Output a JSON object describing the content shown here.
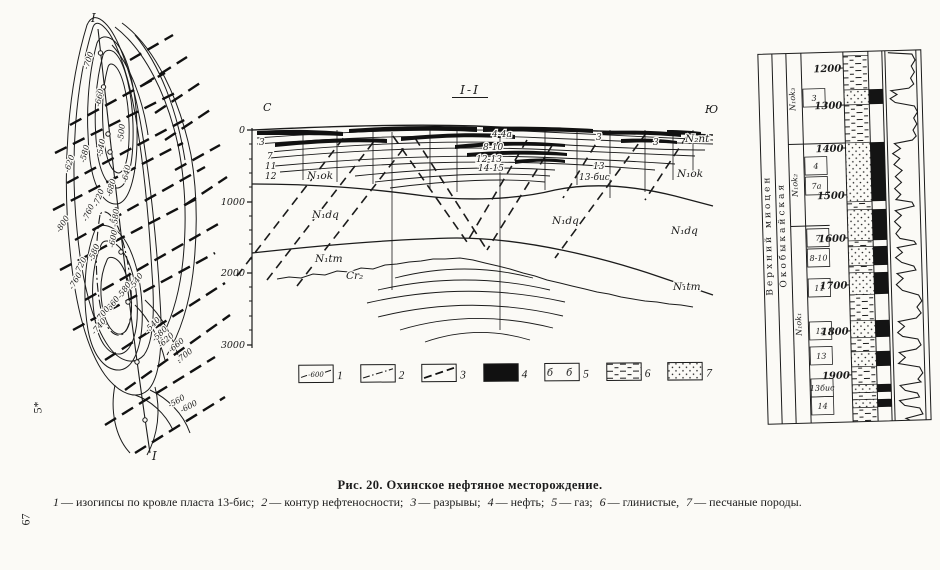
{
  "page": {
    "caption_title": "Рис. 20. Охинское нефтяное месторождение.",
    "caption_parts": [
      {
        "n": "1",
        "t": "— изогипсы по кровле пласта 13-бис;"
      },
      {
        "n": "2",
        "t": "— контур нефтеносности;"
      },
      {
        "n": "3",
        "t": "— разрывы;"
      },
      {
        "n": "4",
        "t": "— нефть;"
      },
      {
        "n": "5",
        "t": "— газ;"
      },
      {
        "n": "6",
        "t": "— глинистые,"
      },
      {
        "n": "7",
        "t": "— песчаные породы."
      }
    ],
    "margin_mark": "5*",
    "page_number": "67"
  },
  "map": {
    "section_label_top": "I",
    "section_label_bottom": "I",
    "contour_labels": [
      {
        "t": "-700",
        "x": 73,
        "y": 65,
        "r": -72
      },
      {
        "t": "-660",
        "x": 85,
        "y": 102,
        "r": -78
      },
      {
        "t": "-540",
        "x": 87,
        "y": 152,
        "r": -80
      },
      {
        "t": "-580",
        "x": 70,
        "y": 158,
        "r": -76
      },
      {
        "t": "-620",
        "x": 54,
        "y": 168,
        "r": -72
      },
      {
        "t": "-500",
        "x": 108,
        "y": 137,
        "r": -84
      },
      {
        "t": "-640",
        "x": 112,
        "y": 178,
        "r": -78
      },
      {
        "t": "-680",
        "x": 96,
        "y": 192,
        "r": -74
      },
      {
        "t": "-720",
        "x": 83,
        "y": 202,
        "r": -70
      },
      {
        "t": "-760",
        "x": 72,
        "y": 217,
        "r": -66
      },
      {
        "t": "-800",
        "x": 45,
        "y": 228,
        "r": -58
      },
      {
        "t": "-580",
        "x": 102,
        "y": 222,
        "r": -84
      },
      {
        "t": "-600",
        "x": 99,
        "y": 243,
        "r": -80
      },
      {
        "t": "-580",
        "x": 78,
        "y": 257,
        "r": -68
      },
      {
        "t": "-720",
        "x": 64,
        "y": 270,
        "r": -64
      },
      {
        "t": "-760",
        "x": 58,
        "y": 285,
        "r": -60
      },
      {
        "t": "-540",
        "x": 118,
        "y": 285,
        "r": -55
      },
      {
        "t": "-580",
        "x": 106,
        "y": 294,
        "r": -55
      },
      {
        "t": "-660",
        "x": 94,
        "y": 308,
        "r": -53
      },
      {
        "t": "-700",
        "x": 84,
        "y": 318,
        "r": -52
      },
      {
        "t": "-740",
        "x": 80,
        "y": 330,
        "r": -50
      },
      {
        "t": "-540",
        "x": 133,
        "y": 328,
        "r": -45
      },
      {
        "t": "-580",
        "x": 140,
        "y": 337,
        "r": -44
      },
      {
        "t": "-620",
        "x": 146,
        "y": 343,
        "r": -42
      },
      {
        "t": "-660",
        "x": 156,
        "y": 348,
        "r": -40
      },
      {
        "t": "-700",
        "x": 164,
        "y": 358,
        "r": -38
      },
      {
        "t": "-560",
        "x": 155,
        "y": 403,
        "r": -30
      },
      {
        "t": "-600",
        "x": 167,
        "y": 408,
        "r": -28
      }
    ]
  },
  "section": {
    "title": "I-I",
    "north": "С",
    "south": "Ю",
    "depth_labels": [
      {
        "t": "0",
        "y": 50
      },
      {
        "t": "1000",
        "y": 122
      },
      {
        "t": "2000",
        "y": 193
      },
      {
        "t": "3000",
        "y": 265
      }
    ],
    "labels": [
      {
        "t": "3",
        "x": 44,
        "y": 65,
        "c": "num"
      },
      {
        "t": "7",
        "x": 52,
        "y": 79,
        "c": "num"
      },
      {
        "t": "11",
        "x": 50,
        "y": 89,
        "c": "num"
      },
      {
        "t": "12",
        "x": 50,
        "y": 99,
        "c": "num"
      },
      {
        "t": "4-4а",
        "x": 277,
        "y": 57,
        "c": "num"
      },
      {
        "t": "8-10",
        "x": 268,
        "y": 70,
        "c": "num"
      },
      {
        "t": "12-13",
        "x": 261,
        "y": 82,
        "c": "num"
      },
      {
        "t": "14-15",
        "x": 263,
        "y": 91,
        "c": "num"
      },
      {
        "t": "3",
        "x": 381,
        "y": 60,
        "c": "num"
      },
      {
        "t": "3",
        "x": 438,
        "y": 65,
        "c": "num"
      },
      {
        "t": "13",
        "x": 378,
        "y": 89,
        "c": "num"
      },
      {
        "t": "13-бис",
        "x": 364,
        "y": 100,
        "c": "num"
      },
      {
        "t": "N₂nt",
        "x": 470,
        "y": 62,
        "c": "fm"
      },
      {
        "t": "N₁ok",
        "x": 92,
        "y": 99,
        "c": "fm"
      },
      {
        "t": "N₁ok",
        "x": 462,
        "y": 97,
        "c": "fm"
      },
      {
        "t": "N₁dq",
        "x": 97,
        "y": 138,
        "c": "fm"
      },
      {
        "t": "N₁dq",
        "x": 337,
        "y": 144,
        "c": "fm"
      },
      {
        "t": "N₁dq",
        "x": 456,
        "y": 154,
        "c": "fm"
      },
      {
        "t": "N₁tm",
        "x": 100,
        "y": 182,
        "c": "fm"
      },
      {
        "t": "Cr₂",
        "x": 131,
        "y": 199,
        "c": "fm"
      },
      {
        "t": "N₁tm",
        "x": 458,
        "y": 210,
        "c": "fm"
      }
    ]
  },
  "legend": {
    "items": [
      {
        "n": "1",
        "kind": "isohypse",
        "inner": "-600"
      },
      {
        "n": "2",
        "kind": "oil-contour",
        "inner": ""
      },
      {
        "n": "3",
        "kind": "fault",
        "inner": ""
      },
      {
        "n": "4",
        "kind": "oil",
        "inner": ""
      },
      {
        "n": "5",
        "kind": "gas",
        "inner": "б б"
      },
      {
        "n": "6",
        "kind": "clay",
        "inner": ""
      },
      {
        "n": "7",
        "kind": "sand",
        "inner": ""
      }
    ]
  },
  "column": {
    "stage": "Верхний миоцен",
    "suite": "Окобыкайская",
    "subsuites": [
      {
        "t": "N₁ok₃",
        "y": 50
      },
      {
        "t": "N₁ok₂",
        "y": 136
      },
      {
        "t": "N₁ok₁",
        "y": 275
      }
    ],
    "depths": [
      {
        "t": "1200",
        "y": 20
      },
      {
        "t": "1300",
        "y": 57
      },
      {
        "t": "1400",
        "y": 100
      },
      {
        "t": "1500",
        "y": 147
      },
      {
        "t": "1600",
        "y": 190
      },
      {
        "t": "1700",
        "y": 237
      },
      {
        "t": "1800",
        "y": 283
      },
      {
        "t": "1900",
        "y": 327
      }
    ],
    "layers": [
      {
        "t": "3",
        "y": 49
      },
      {
        "t": "4",
        "y": 117
      },
      {
        "t": "7а",
        "y": 137
      },
      {
        "t": "7",
        "y": 189
      },
      {
        "t": "8-10",
        "y": 209
      },
      {
        "t": "11",
        "y": 239
      },
      {
        "t": "12",
        "y": 282
      },
      {
        "t": "13",
        "y": 307
      },
      {
        "t": "13бис",
        "y": 339
      },
      {
        "t": "14",
        "y": 357
      }
    ],
    "lithology": [
      {
        "y": 8,
        "h": 34,
        "lith": "clay",
        "oil": false
      },
      {
        "y": 42,
        "h": 15,
        "lith": "sand",
        "oil": true
      },
      {
        "y": 57,
        "h": 38,
        "lith": "clay",
        "oil": false
      },
      {
        "y": 95,
        "h": 59,
        "lith": "sand",
        "oil": true
      },
      {
        "y": 154,
        "h": 8,
        "lith": "clay",
        "oil": false
      },
      {
        "y": 162,
        "h": 31,
        "lith": "sand",
        "oil": true
      },
      {
        "y": 193,
        "h": 6,
        "lith": "clay",
        "oil": false
      },
      {
        "y": 199,
        "h": 19,
        "lith": "sand",
        "oil": true
      },
      {
        "y": 218,
        "h": 7,
        "lith": "clay",
        "oil": false
      },
      {
        "y": 225,
        "h": 22,
        "lith": "sand",
        "oil": true
      },
      {
        "y": 247,
        "h": 26,
        "lith": "clay",
        "oil": false
      },
      {
        "y": 273,
        "h": 17,
        "lith": "sand",
        "oil": true
      },
      {
        "y": 290,
        "h": 14,
        "lith": "clay",
        "oil": false
      },
      {
        "y": 304,
        "h": 15,
        "lith": "sand",
        "oil": true
      },
      {
        "y": 319,
        "h": 18,
        "lith": "clay",
        "oil": false
      },
      {
        "y": 337,
        "h": 8,
        "lith": "sand",
        "oil": true
      },
      {
        "y": 345,
        "h": 7,
        "lith": "clay",
        "oil": false
      },
      {
        "y": 352,
        "h": 8,
        "lith": "sand",
        "oil": true
      },
      {
        "y": 360,
        "h": 14,
        "lith": "clay",
        "oil": false
      }
    ]
  }
}
